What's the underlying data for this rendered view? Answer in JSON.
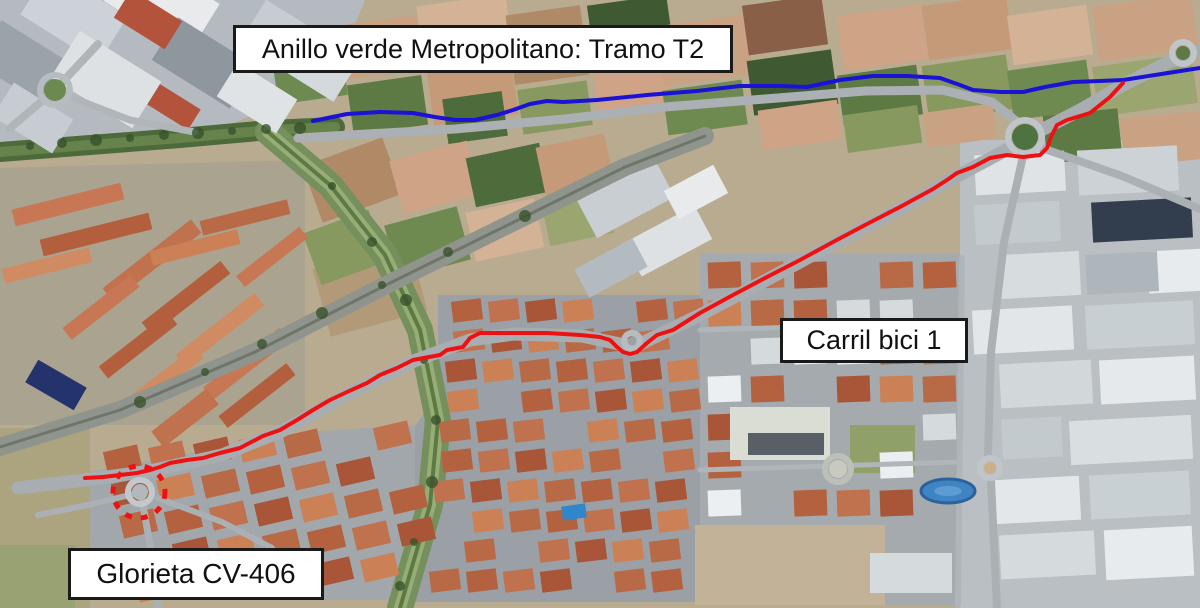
{
  "figure": {
    "type": "annotated-satellite-map",
    "labels": {
      "title": "Anillo verde Metropolitano: Tramo T2",
      "bike_lane": "Carril bici 1",
      "roundabout": "Glorieta CV-406"
    },
    "routes": {
      "anillo_verde": {
        "color": "#1a13d6",
        "points": "313,121 347,114 380,112 413,113 435,117 455,120 475,120 497,115 513,110 530,104 547,101 563,102 597,100 647,95 697,91 740,86 780,86 807,87 840,80 873,76 907,76 940,78 960,85 973,90 1000,92 1023,92 1045,87 1073,82 1100,81 1123,80 1155,75 1187,70 1200,68"
      },
      "carril_bici": {
        "color": "#ee1111",
        "points": "85,478 103,477 120,475 137,473 150,470 160,467 170,463 187,460 203,458 220,453 240,448 263,436 280,430 297,420 313,410 330,400 347,392 367,383 380,375 397,368 413,360 440,355 447,350 463,347 470,338 480,333 513,333 547,333 580,335 600,337 610,340 617,347 623,352 630,354 637,352 647,343 657,335 673,330 700,313 733,295 767,277 800,260 833,242 867,224 900,207 933,189 947,180 957,173 973,167 990,158 1007,155 1023,157 1040,155 1047,148 1051,137 1057,125 1067,120 1090,113 1110,97 1123,83"
      },
      "glorieta_marker": {
        "color": "#ee1111",
        "cx": 139,
        "cy": 492,
        "r": 26
      }
    }
  }
}
